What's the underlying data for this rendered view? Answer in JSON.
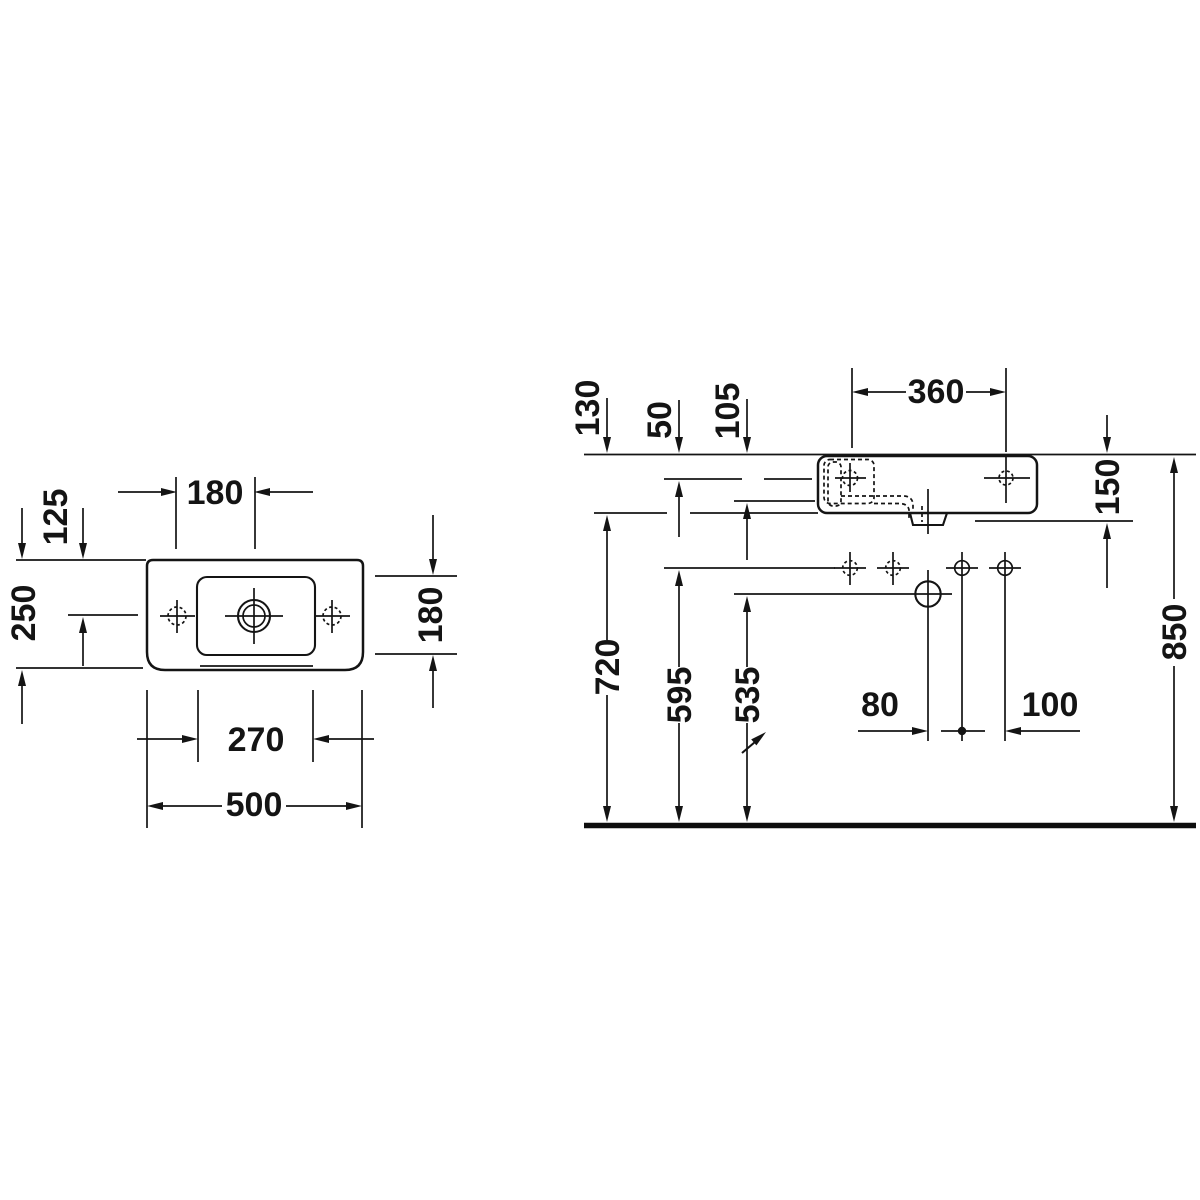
{
  "drawing": {
    "title": "washbasin-technical-dimension-drawing",
    "background_color": "#ffffff",
    "line_color": "#141414",
    "symbols": {
      "direction_arrow": "northeast-arrow",
      "hole_marker": "crosshair-circle"
    },
    "plan": {
      "dim_hole_spacing": "180",
      "dim_front_to_holes": "125",
      "dim_total_depth": "250",
      "dim_bowl_depth": "180",
      "dim_bowl_width": "270",
      "dim_total_width": "500"
    },
    "elevation": {
      "dim_rim_to_body_bottom": "130",
      "dim_rim_to_tap_axis": "50",
      "dim_rim_to_bowl_bottom": "105",
      "dim_tap_hole_spacing": "360",
      "dim_rim_to_outlet": "150",
      "dim_body_bottom_height": "720",
      "dim_fixing_hole_height": "595",
      "dim_drain_height": "535",
      "dim_drain_offset": "80",
      "dim_fixing_offset": "100",
      "dim_rim_height": "850"
    }
  }
}
